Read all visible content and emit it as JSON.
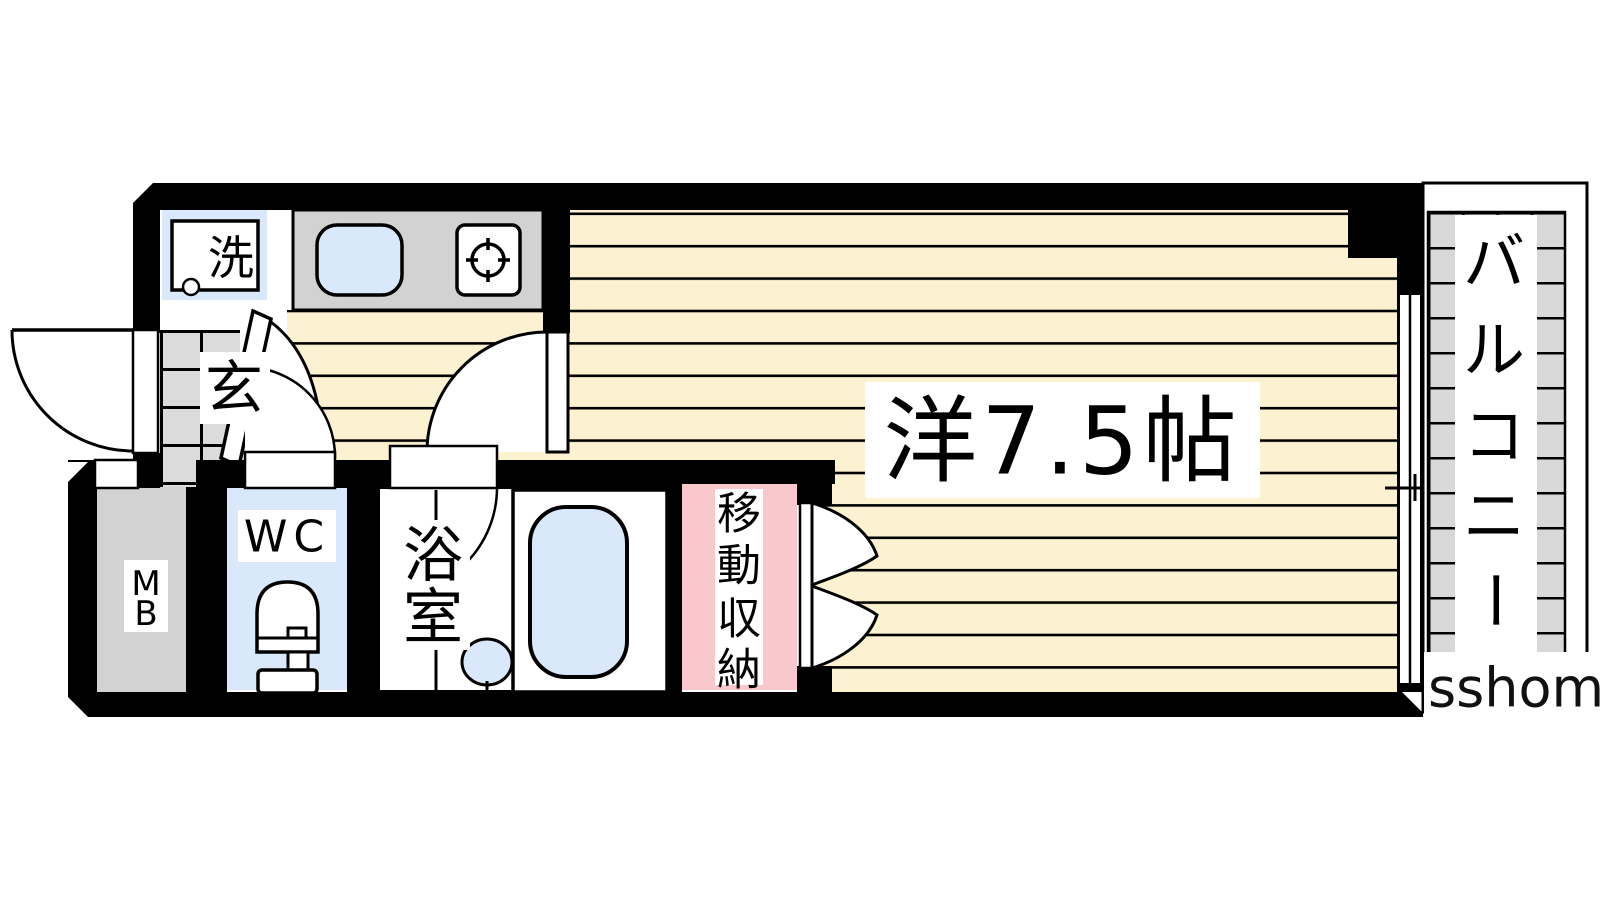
{
  "floorplan": {
    "rooms": {
      "living": {
        "label": "洋7.5帖"
      },
      "balcony": {
        "label": "バルコニー",
        "chars": [
          "バ",
          "ル",
          "コ",
          "ニ",
          "ー"
        ]
      },
      "entrance": {
        "label": "玄"
      },
      "laundry": {
        "label": "洗"
      },
      "toilet": {
        "label": "WC"
      },
      "bathroom": {
        "label": "浴室",
        "chars": [
          "浴",
          "室"
        ]
      },
      "meter_box": {
        "label": "MB",
        "chars": [
          "M",
          "B"
        ]
      },
      "storage": {
        "label": "移動収納",
        "chars": [
          "移",
          "動",
          "収",
          "納"
        ]
      }
    },
    "watermark": "sshome",
    "colors": {
      "wall": "#000000",
      "flooring": "#FCF1D1",
      "water_blue": "#D9E9FB",
      "counter_gray": "#D2D2D2",
      "tile_gray": "#D8D8D8",
      "genkan_gray": "#DBDBDB",
      "storage_pink": "#F8C8CD"
    }
  }
}
